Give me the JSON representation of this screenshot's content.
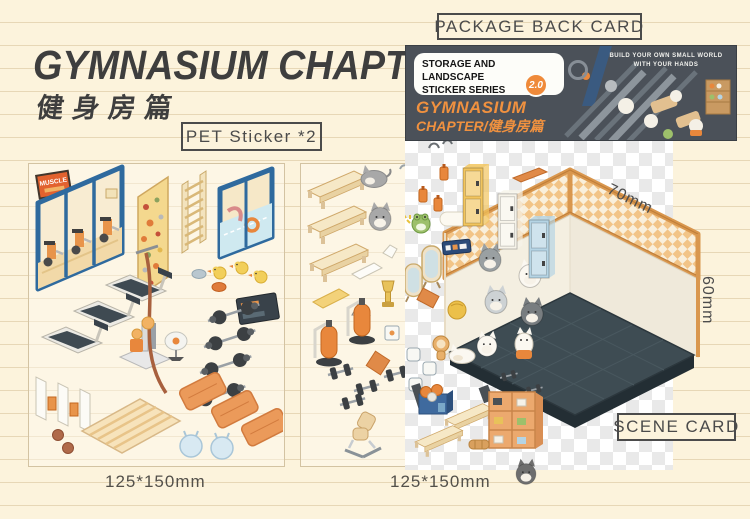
{
  "header": {
    "title": "GYMNASIUM CHAPTER",
    "subtitle_cn": "健身房篇"
  },
  "labels": {
    "pet_sticker": "PET Sticker *2",
    "package_back_card": "PACKAGE BACK CARD",
    "scene_card": "SCENE CARD",
    "sheet1_size": "125*150mm",
    "sheet2_size": "125*150mm",
    "scene_width_mm": "70mm",
    "scene_height_mm": "60mm"
  },
  "package": {
    "series_line1": "STORAGE AND LANDSCAPE",
    "series_line2": "STICKER SERIES",
    "version_badge": "2.0",
    "title_line1": "GYMNASIUM",
    "title_line2": "CHAPTER/健身房篇",
    "tagline_line1": "BUILD YOUR OWN SMALL WORLD",
    "tagline_line2": "WITH YOUR HANDS"
  },
  "sheet1": {
    "sign_text": "MUSCLE",
    "items": [
      "muscle-sign",
      "gym-window-with-spin-bikes",
      "climbing-wall",
      "wall-bars-ladder",
      "pool-window",
      "rubber-ducks",
      "stones",
      "treadmills",
      "cable-machine",
      "climbing-rope",
      "floor-fan",
      "tv-screen",
      "barbells",
      "shoe-cubby-gates",
      "wood-floor-mat",
      "medicine-balls",
      "orange-gym-mats",
      "hop-balls"
    ]
  },
  "sheet2": {
    "items": [
      "wooden-benches",
      "gray-cats",
      "white-mat",
      "yellow-mat",
      "trophy",
      "warning-triangle",
      "punching-bags",
      "dumbbells",
      "workout-benches",
      "picture-frames",
      "orange-mat"
    ]
  },
  "scene": {
    "items": [
      "water-bottles",
      "frog",
      "yellow-locker",
      "white-locker",
      "blue-locker",
      "standing-mirrors",
      "wall-sign",
      "orange-mat",
      "yellow-ball",
      "lion-toy",
      "picture-frames",
      "basketball-box",
      "wooden-benches",
      "shoe-shelf",
      "cat-stickers",
      "checkered-wall-band",
      "white-walls",
      "dark-tile-floor"
    ]
  },
  "colors": {
    "paper": "#fcf3dc",
    "paper_line": "#e7d7b6",
    "ink": "#3e3e3e",
    "label_border": "#4b4b4b",
    "package_bg": "#4b5159",
    "accent_orange": "#ef8a3a",
    "pkg_title_orange": "#f0913f",
    "frame_blue": "#2f6a9e",
    "wood_trim": "#d9974e",
    "wall_band_check": "#f2c487",
    "wall_white": "#f4efe1",
    "floor_dark": "#3e4c53",
    "locker_yellow": "#f2c55e",
    "locker_blue": "#b5d4e4",
    "mat_orange": "#eb9a5a",
    "climb_wall_yellow": "#f4d88e"
  }
}
